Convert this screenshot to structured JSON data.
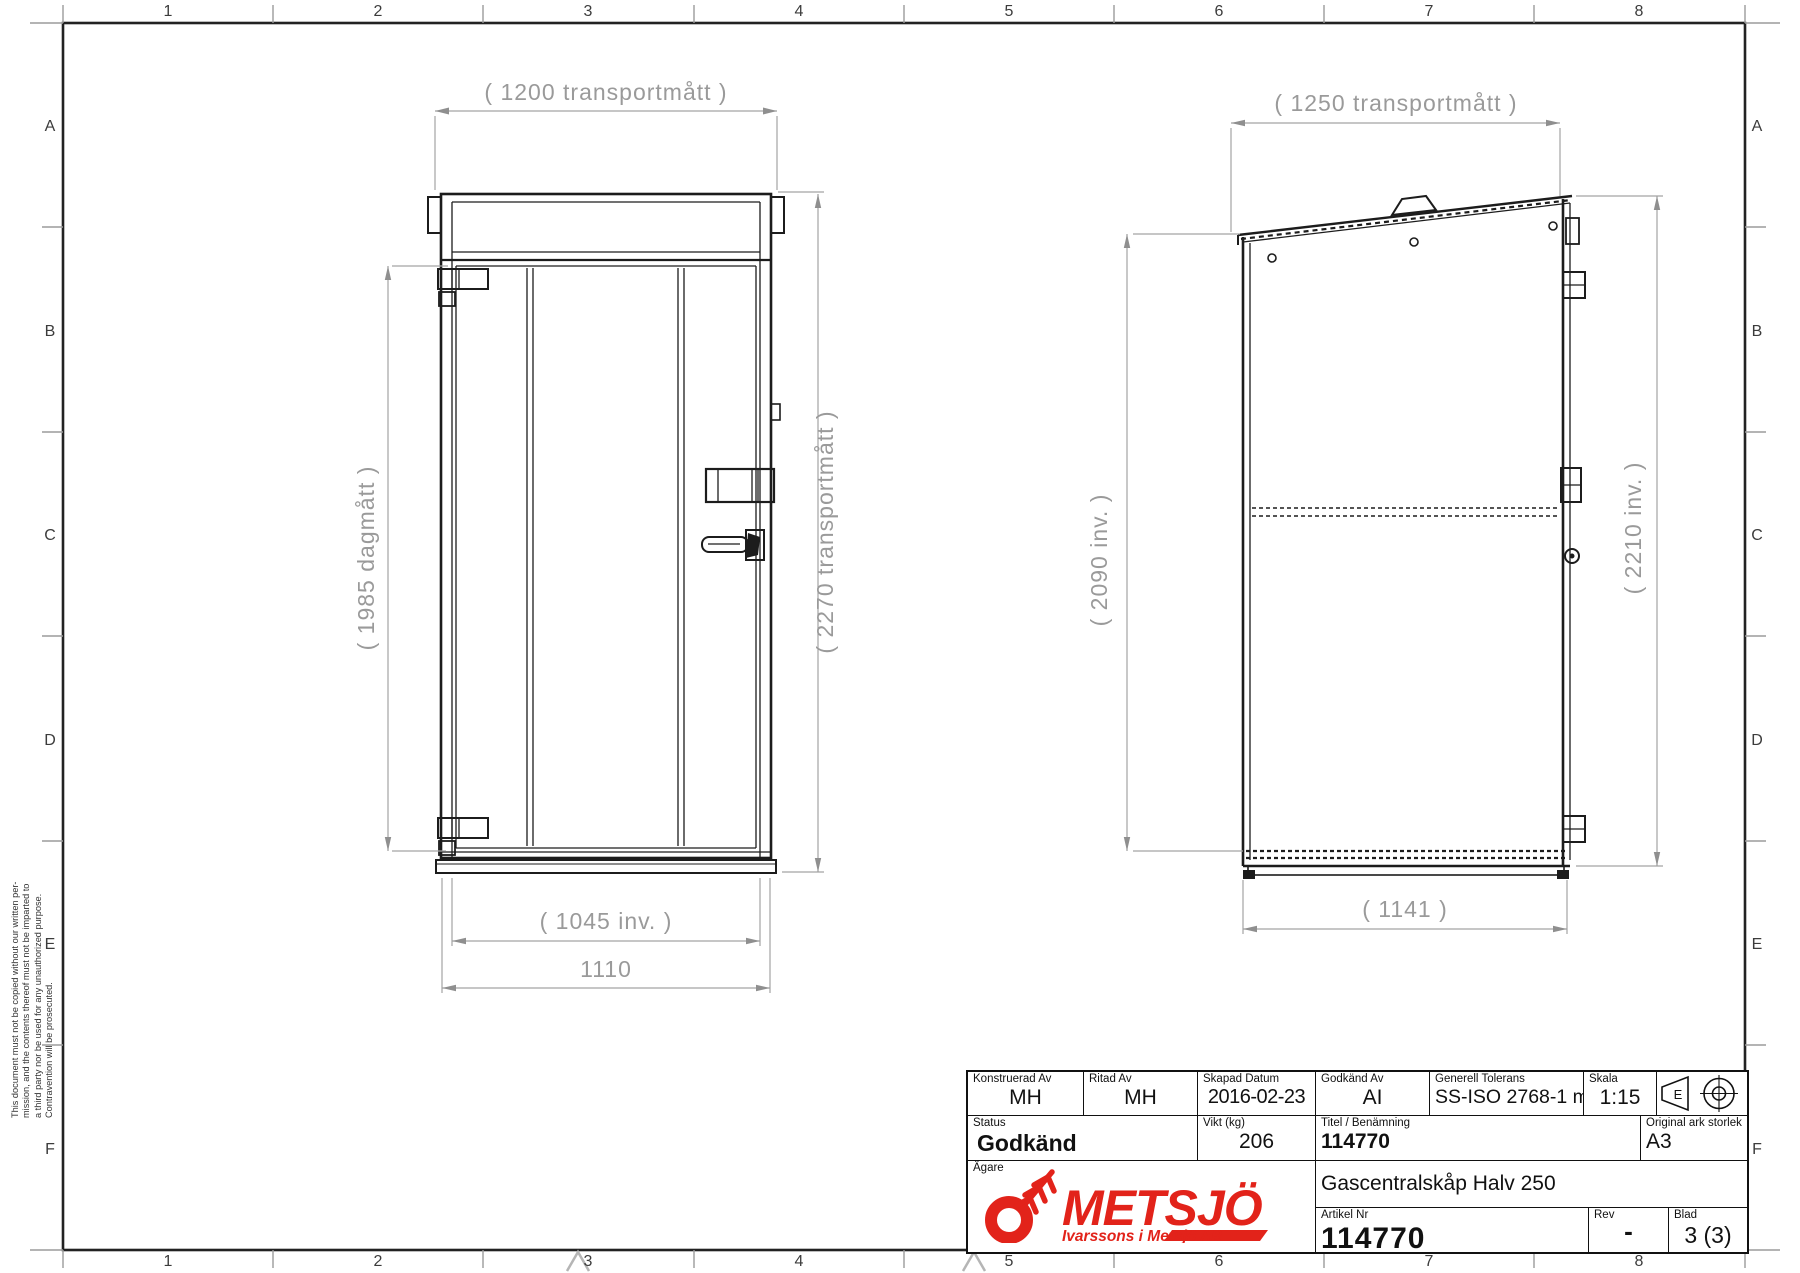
{
  "sheet": {
    "zone_columns": [
      "1",
      "2",
      "3",
      "4",
      "5",
      "6",
      "7",
      "8"
    ],
    "zone_rows": [
      "A",
      "B",
      "C",
      "D",
      "E",
      "F"
    ],
    "disclaimer_lines": {
      "l1": "This document must not be copied without our written per-",
      "l2": "mission, and the contents thereof must not be imparted to",
      "l3": "a third party nor be used for any unauthorized purpose.",
      "l4": "Contravention will be prosecuted."
    }
  },
  "front_view": {
    "dim_top": "( 1200 transportmått )",
    "dim_door_height": "( 1985 dagmått )",
    "dim_total_height": "( 2270 transportmått )",
    "dim_inner_width": "( 1045 inv. )",
    "dim_width": "1110"
  },
  "side_view": {
    "dim_top": "( 1250 transportmått )",
    "dim_left_height": "( 2090 inv. )",
    "dim_right_height": "( 2210 inv. )",
    "dim_bottom": "( 1141 )"
  },
  "title_block": {
    "konstruerad": {
      "label": "Konstruerad Av",
      "value": "MH"
    },
    "ritad": {
      "label": "Ritad Av",
      "value": "MH"
    },
    "skapad": {
      "label": "Skapad Datum",
      "value": "2016-02-23"
    },
    "godkand": {
      "label": "Godkänd Av",
      "value": "AI"
    },
    "tolerans": {
      "label": "Generell Tolerans",
      "value": "SS-ISO 2768-1 m"
    },
    "skala": {
      "label": "Skala",
      "value": "1:15"
    },
    "status": {
      "label": "Status",
      "value": "Godkänd"
    },
    "vikt": {
      "label": "Vikt (kg)",
      "value": "206"
    },
    "titel": {
      "label": "Titel / Benämning",
      "value": "114770",
      "value2": "Gascentralskåp Halv 250"
    },
    "original_ark": {
      "label": "Original ark storlek",
      "value": "A3"
    },
    "agare": {
      "label": "Ägare"
    },
    "artikel": {
      "label": "Artikel Nr",
      "value": "114770"
    },
    "rev": {
      "label": "Rev",
      "value": "-"
    },
    "blad": {
      "label": "Blad",
      "value": "3 (3)"
    },
    "projection_symbol": "E"
  },
  "logo": {
    "name": "METSJÖ",
    "tagline": "Ivarssons i Metsjö AB",
    "color": "#e2231a"
  }
}
